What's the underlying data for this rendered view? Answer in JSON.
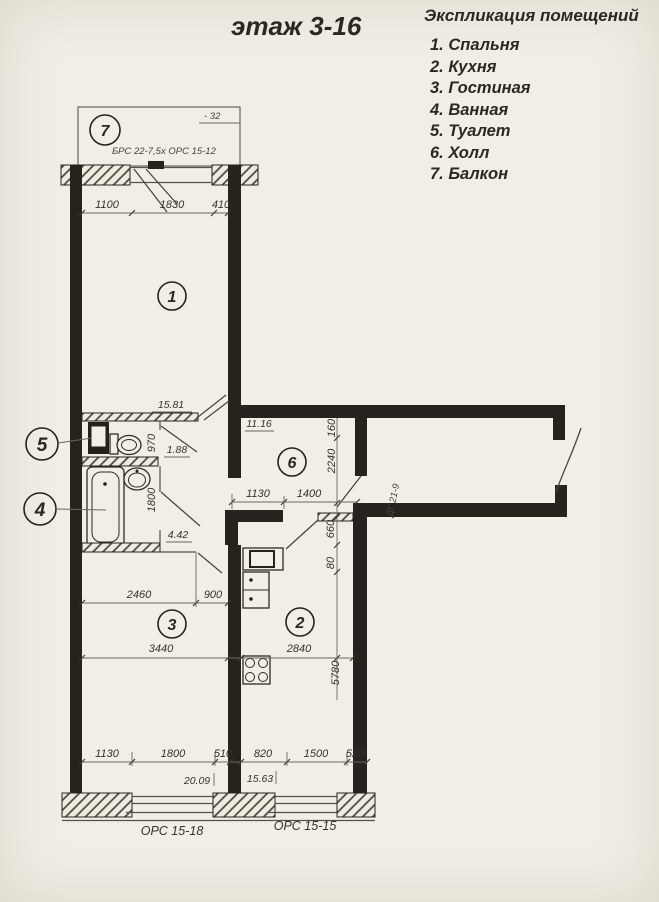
{
  "title": "этаж 3-16",
  "legend": {
    "heading": "Экспликация помещений",
    "items": [
      "1. Спальня",
      "2. Кухня",
      "3. Гостиная",
      "4. Ванная",
      "5. Туалет",
      "6. Холл",
      "7. Балкон"
    ]
  },
  "plan": {
    "rooms": {
      "bedroom": "1",
      "kitchen": "2",
      "living": "3",
      "bath": "4",
      "wc": "5",
      "hall": "6",
      "balcony": "7"
    },
    "areas": {
      "bedroom": "15.81",
      "wc": "1.88",
      "bath": "4.42",
      "hall": "11.16",
      "living": "20.09",
      "kitchen": "15.63"
    },
    "marks": {
      "balcony_elev": "- 32",
      "balcony_block": "БРС 22-7,5х ОРС 15-12",
      "door": "ДГ 21-9",
      "window_left": "ОРС 15-18",
      "window_right": "ОРС 15-15"
    },
    "dims": {
      "bedroom_top": [
        "1100",
        "1830",
        "410"
      ],
      "wc": "970",
      "bath": "1800",
      "hall_h": [
        "1130",
        "1400"
      ],
      "hall_v": [
        "160",
        "2240"
      ],
      "kitchen_v": [
        "660",
        "80",
        "5780"
      ],
      "kitchen_w": "2840",
      "living_top": [
        "2460",
        "900"
      ],
      "living_w": "3440",
      "bottom": [
        "1130",
        "1800",
        "510",
        "820",
        "1500",
        "520"
      ]
    }
  }
}
